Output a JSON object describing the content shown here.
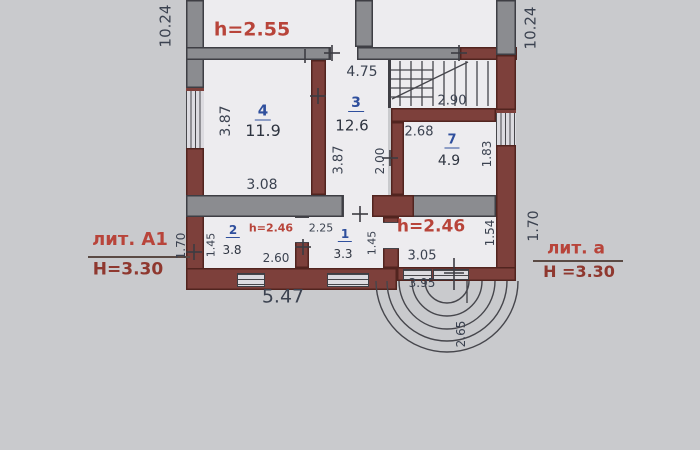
{
  "plan": {
    "heights": {
      "upper": "h=2.55",
      "room2": "h=2.46",
      "veranda": "h=2.46"
    },
    "blocks": {
      "left": {
        "lit": "лит. А1",
        "height": "Н=3.30"
      },
      "right": {
        "lit": "лит. а",
        "height": "Н =3.30"
      }
    },
    "rooms": {
      "r4": {
        "num": "4",
        "area": "11.9",
        "width": "3.08",
        "depth": "3.87"
      },
      "r3": {
        "num": "3",
        "area": "12.6",
        "top": "4.75",
        "left": "3.87",
        "right": "2.00"
      },
      "r7": {
        "num": "7",
        "area": "4.9",
        "top": "2.68",
        "right": "1.83"
      },
      "r2": {
        "num": "2",
        "area": "3.8",
        "left": "1.45",
        "bottom": "2.60"
      },
      "r1": {
        "num": "1",
        "area": "3.3",
        "top": "2.25",
        "right": "1.45"
      },
      "veranda": {
        "width_inner": "3.05",
        "width_outer": "3.95",
        "right": "1.54",
        "steps": "2.65"
      }
    },
    "dims": {
      "left_total": "10.24",
      "right_total": "10.24",
      "stairs": "2.90",
      "left_offset": "1.70",
      "right_offset": "1.70",
      "bottom_total": "5.47"
    }
  }
}
